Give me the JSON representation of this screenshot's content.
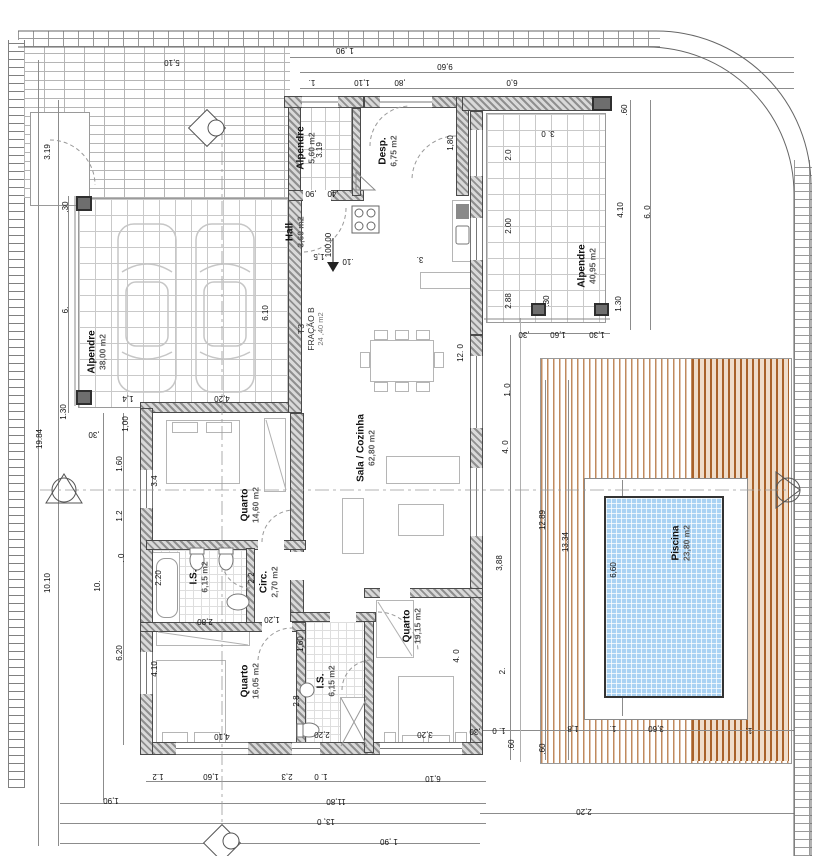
{
  "plan": {
    "rooms": [
      {
        "name": "Alpendre",
        "area": "38,00 m2"
      },
      {
        "name": "Alpendre",
        "area": "5,60 m2"
      },
      {
        "name": "Hall",
        "area": "3,60 m2"
      },
      {
        "name": "Desp.",
        "area": "6,75 m2"
      },
      {
        "name": "Alpendre",
        "area": "40,95 m2"
      },
      {
        "name": "Sala / Cozinha",
        "area": "62,80 m2"
      },
      {
        "name": "Quarto",
        "area": "14,60 m2"
      },
      {
        "name": "I.S.",
        "area": "6,15 m2"
      },
      {
        "name": "Circ.",
        "area": "2,70 m2"
      },
      {
        "name": "Quarto",
        "area": "16,05 m2"
      },
      {
        "name": "I.S.",
        "area": "6,15 m2"
      },
      {
        "name": "Quarto",
        "area": "19,15 m2"
      },
      {
        "name": "Piscina",
        "area": "23,80 m2"
      }
    ],
    "unit": {
      "label": "T3",
      "fraction": "FRAÇÃO B",
      "area": "24 ,40 m2"
    },
    "level_marker": "100.00",
    "dims": [
      {
        "v": "1 ,90",
        "x": 345,
        "y": 50,
        "r": 180
      },
      {
        "v": "9,60",
        "x": 445,
        "y": 66,
        "r": 180
      },
      {
        "v": "1.",
        "x": 312,
        "y": 82,
        "r": 180
      },
      {
        "v": "1,10",
        "x": 362,
        "y": 82,
        "r": 180
      },
      {
        "v": ",80",
        "x": 400,
        "y": 82,
        "r": 180
      },
      {
        "v": "6,0",
        "x": 512,
        "y": 82,
        "r": 180
      },
      {
        "v": "5,10",
        "x": 172,
        "y": 62,
        "r": 180
      },
      {
        "v": "3.19",
        "x": 320,
        "y": 150,
        "r": 90
      },
      {
        "v": "3.19",
        "x": 48,
        "y": 152,
        "r": 90
      },
      {
        "v": ".60",
        "x": 625,
        "y": 110,
        "r": 90
      },
      {
        "v": "3. 0",
        "x": 548,
        "y": 133,
        "r": 180
      },
      {
        "v": "2.0",
        "x": 509,
        "y": 155,
        "r": 90
      },
      {
        "v": "2.00",
        "x": 509,
        "y": 226,
        "r": 90
      },
      {
        "v": "2.88",
        "x": 509,
        "y": 301,
        "r": 90
      },
      {
        "v": "4.10",
        "x": 621,
        "y": 210,
        "r": 90
      },
      {
        "v": "6. 0",
        "x": 648,
        "y": 212,
        "r": 90
      },
      {
        "v": "1.30",
        "x": 619,
        "y": 304,
        "r": 90
      },
      {
        "v": ".30",
        "x": 547,
        "y": 301,
        "r": 90
      },
      {
        "v": "1,30",
        "x": 597,
        "y": 334,
        "r": 180
      },
      {
        "v": "1,60",
        "x": 558,
        "y": 334,
        "r": 180
      },
      {
        "v": ",30",
        "x": 524,
        "y": 334,
        "r": 180
      },
      {
        "v": "1. 0",
        "x": 508,
        "y": 390,
        "r": 90
      },
      {
        "v": "4. 0",
        "x": 506,
        "y": 447,
        "r": 90
      },
      {
        "v": "12.89",
        "x": 543,
        "y": 520,
        "r": 90
      },
      {
        "v": "13.34",
        "x": 566,
        "y": 542,
        "r": 90
      },
      {
        "v": "6,60",
        "x": 614,
        "y": 570,
        "r": 90
      },
      {
        "v": "3,88",
        "x": 500,
        "y": 563,
        "r": 90
      },
      {
        "v": "2.",
        "x": 503,
        "y": 671,
        "r": 90
      },
      {
        "v": "12. 0",
        "x": 461,
        "y": 353,
        "r": 90
      },
      {
        "v": "6.10",
        "x": 266,
        "y": 313,
        "r": 90
      },
      {
        "v": ".30",
        "x": 66,
        "y": 207,
        "r": 90
      },
      {
        "v": "6.",
        "x": 66,
        "y": 310,
        "r": 90
      },
      {
        "v": "1.30",
        "x": 64,
        "y": 412,
        "r": 90
      },
      {
        "v": "1,4",
        "x": 128,
        "y": 398,
        "r": 180
      },
      {
        "v": "4,20",
        "x": 222,
        "y": 398,
        "r": 180
      },
      {
        "v": ",30",
        "x": 94,
        "y": 434,
        "r": 180
      },
      {
        "v": "1,00",
        "x": 126,
        "y": 424,
        "r": 90
      },
      {
        "v": "1.60",
        "x": 120,
        "y": 464,
        "r": 90
      },
      {
        "v": "1.2",
        "x": 120,
        "y": 516,
        "r": 90
      },
      {
        "v": ". 0",
        "x": 122,
        "y": 558,
        "r": 90
      },
      {
        "v": "3.4",
        "x": 155,
        "y": 481,
        "r": 90
      },
      {
        "v": "2.20",
        "x": 159,
        "y": 578,
        "r": 90
      },
      {
        "v": "2.2",
        "x": 252,
        "y": 578,
        "r": 90
      },
      {
        "v": "2,80",
        "x": 205,
        "y": 621,
        "r": 180
      },
      {
        "v": "1,20",
        "x": 272,
        "y": 619,
        "r": 180
      },
      {
        "v": "1,60",
        "x": 301,
        "y": 644,
        "r": 90
      },
      {
        "v": "4.10",
        "x": 155,
        "y": 669,
        "r": 90
      },
      {
        "v": "4,10",
        "x": 222,
        "y": 736,
        "r": 180
      },
      {
        "v": "2,8",
        "x": 297,
        "y": 701,
        "r": 90
      },
      {
        "v": "2,20",
        "x": 322,
        "y": 734,
        "r": 180
      },
      {
        "v": "3,20",
        "x": 425,
        "y": 734,
        "r": 180
      },
      {
        "v": "4. 0",
        "x": 457,
        "y": 656,
        "r": 90
      },
      {
        "v": "6.20",
        "x": 120,
        "y": 653,
        "r": 90
      },
      {
        "v": "10.10",
        "x": 48,
        "y": 583,
        "r": 90
      },
      {
        "v": "10.",
        "x": 98,
        "y": 586,
        "r": 90
      },
      {
        "v": "19.84",
        "x": 40,
        "y": 439,
        "r": 90
      },
      {
        "v": ",30",
        "x": 475,
        "y": 731,
        "r": 180
      },
      {
        "v": "1. 0",
        "x": 499,
        "y": 730,
        "r": 180
      },
      {
        "v": ".60",
        "x": 512,
        "y": 745,
        "r": 90
      },
      {
        "v": ".60",
        "x": 543,
        "y": 749,
        "r": 90
      },
      {
        "v": "1,8",
        "x": 573,
        "y": 728,
        "r": 180
      },
      {
        "v": "1.",
        "x": 613,
        "y": 728,
        "r": 180
      },
      {
        "v": "3,60",
        "x": 656,
        "y": 728,
        "r": 180
      },
      {
        "v": "1.",
        "x": 749,
        "y": 730,
        "r": 180
      },
      {
        "v": "2,20",
        "x": 584,
        "y": 811,
        "r": 180
      },
      {
        "v": "1.2",
        "x": 158,
        "y": 776,
        "r": 180
      },
      {
        "v": "1,60",
        "x": 211,
        "y": 776,
        "r": 180
      },
      {
        "v": "2,3",
        "x": 287,
        "y": 776,
        "r": 180
      },
      {
        "v": "1. 0",
        "x": 321,
        "y": 776,
        "r": 180
      },
      {
        "v": "6,10",
        "x": 433,
        "y": 778,
        "r": 180
      },
      {
        "v": "1,90",
        "x": 111,
        "y": 800,
        "r": 180
      },
      {
        "v": "11,80",
        "x": 336,
        "y": 801,
        "r": 180
      },
      {
        "v": "13, 0",
        "x": 326,
        "y": 821,
        "r": 180
      },
      {
        "v": "1 ,90",
        "x": 389,
        "y": 841,
        "r": 180
      },
      {
        "v": "1,5",
        "x": 319,
        "y": 256,
        "r": 180
      },
      {
        "v": ".10",
        "x": 348,
        "y": 261,
        "r": 180
      },
      {
        "v": "3.",
        "x": 420,
        "y": 259,
        "r": 180
      },
      {
        "v": "1,80",
        "x": 451,
        "y": 143,
        "r": 90
      },
      {
        "v": ",90",
        "x": 311,
        "y": 193,
        "r": 180
      },
      {
        "v": ",40",
        "x": 333,
        "y": 193,
        "r": 180
      },
      {
        "v": "100.00",
        "x": 329,
        "y": 245,
        "r": 90
      }
    ]
  }
}
